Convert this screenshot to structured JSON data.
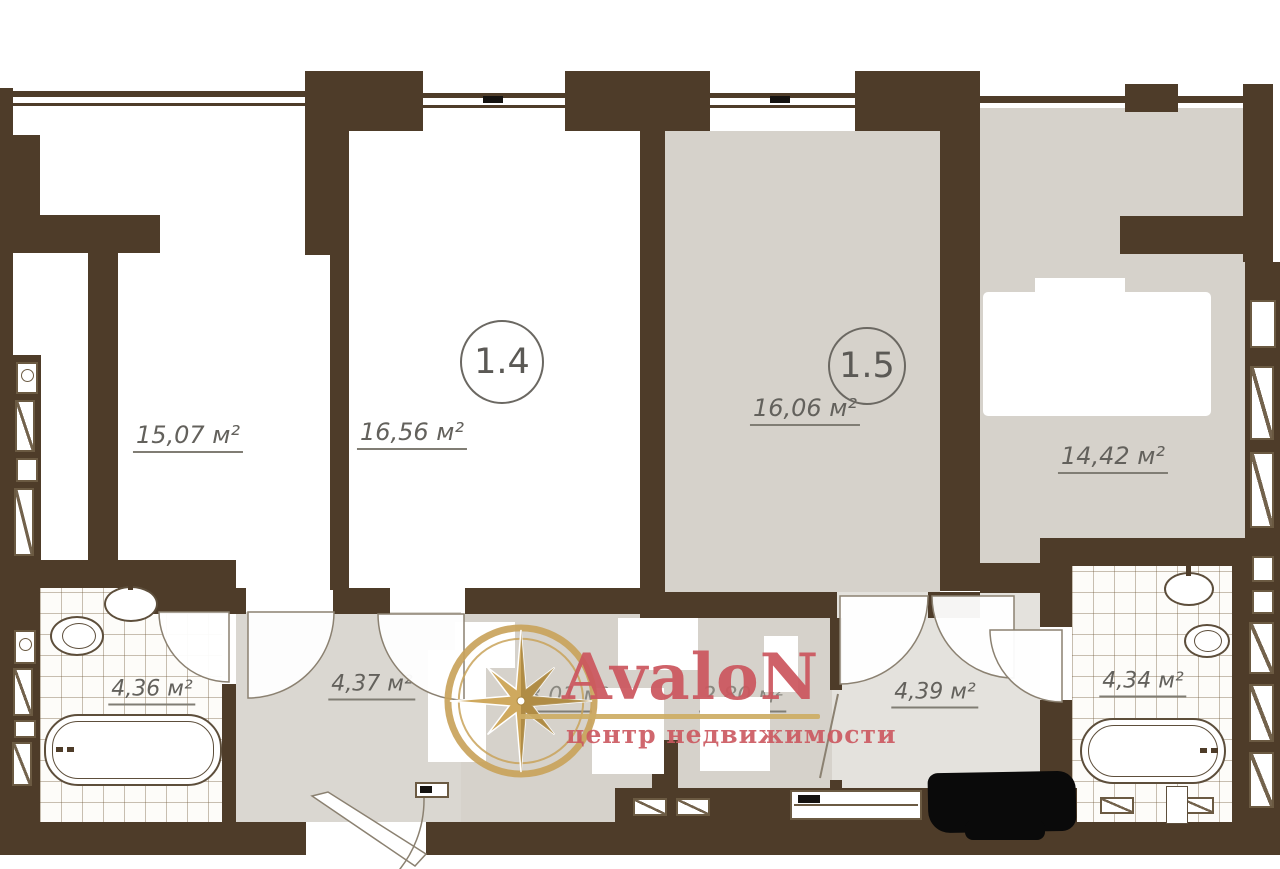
{
  "watermark": {
    "brand": "AvaloN",
    "tagline": "центр недвижимости"
  },
  "rooms": {
    "room_a": {
      "area": "15,07 м²"
    },
    "room_14": {
      "number": "1.4",
      "area": "16,56 м²"
    },
    "room_15": {
      "number": "1.5",
      "area": "16,06 м²"
    },
    "room_right": {
      "area": "14,42 м²"
    },
    "bath_left": {
      "area": "4,36 м²"
    },
    "hall_main": {
      "area": "4,37 м²"
    },
    "hall_small_left": {
      "area": "3,01 м²"
    },
    "hall_small_right": {
      "area": "2,80 м²"
    },
    "hall_right": {
      "area": "4,39 м²"
    },
    "bath_right": {
      "area": "4,34 м²"
    }
  },
  "colors": {
    "wall_brown": "#4e3c29",
    "floor_gray": "#d6d2cb",
    "floor_light": "#e4e2dd",
    "brand_red": "#cb565e",
    "gold": "#c9a35b"
  }
}
